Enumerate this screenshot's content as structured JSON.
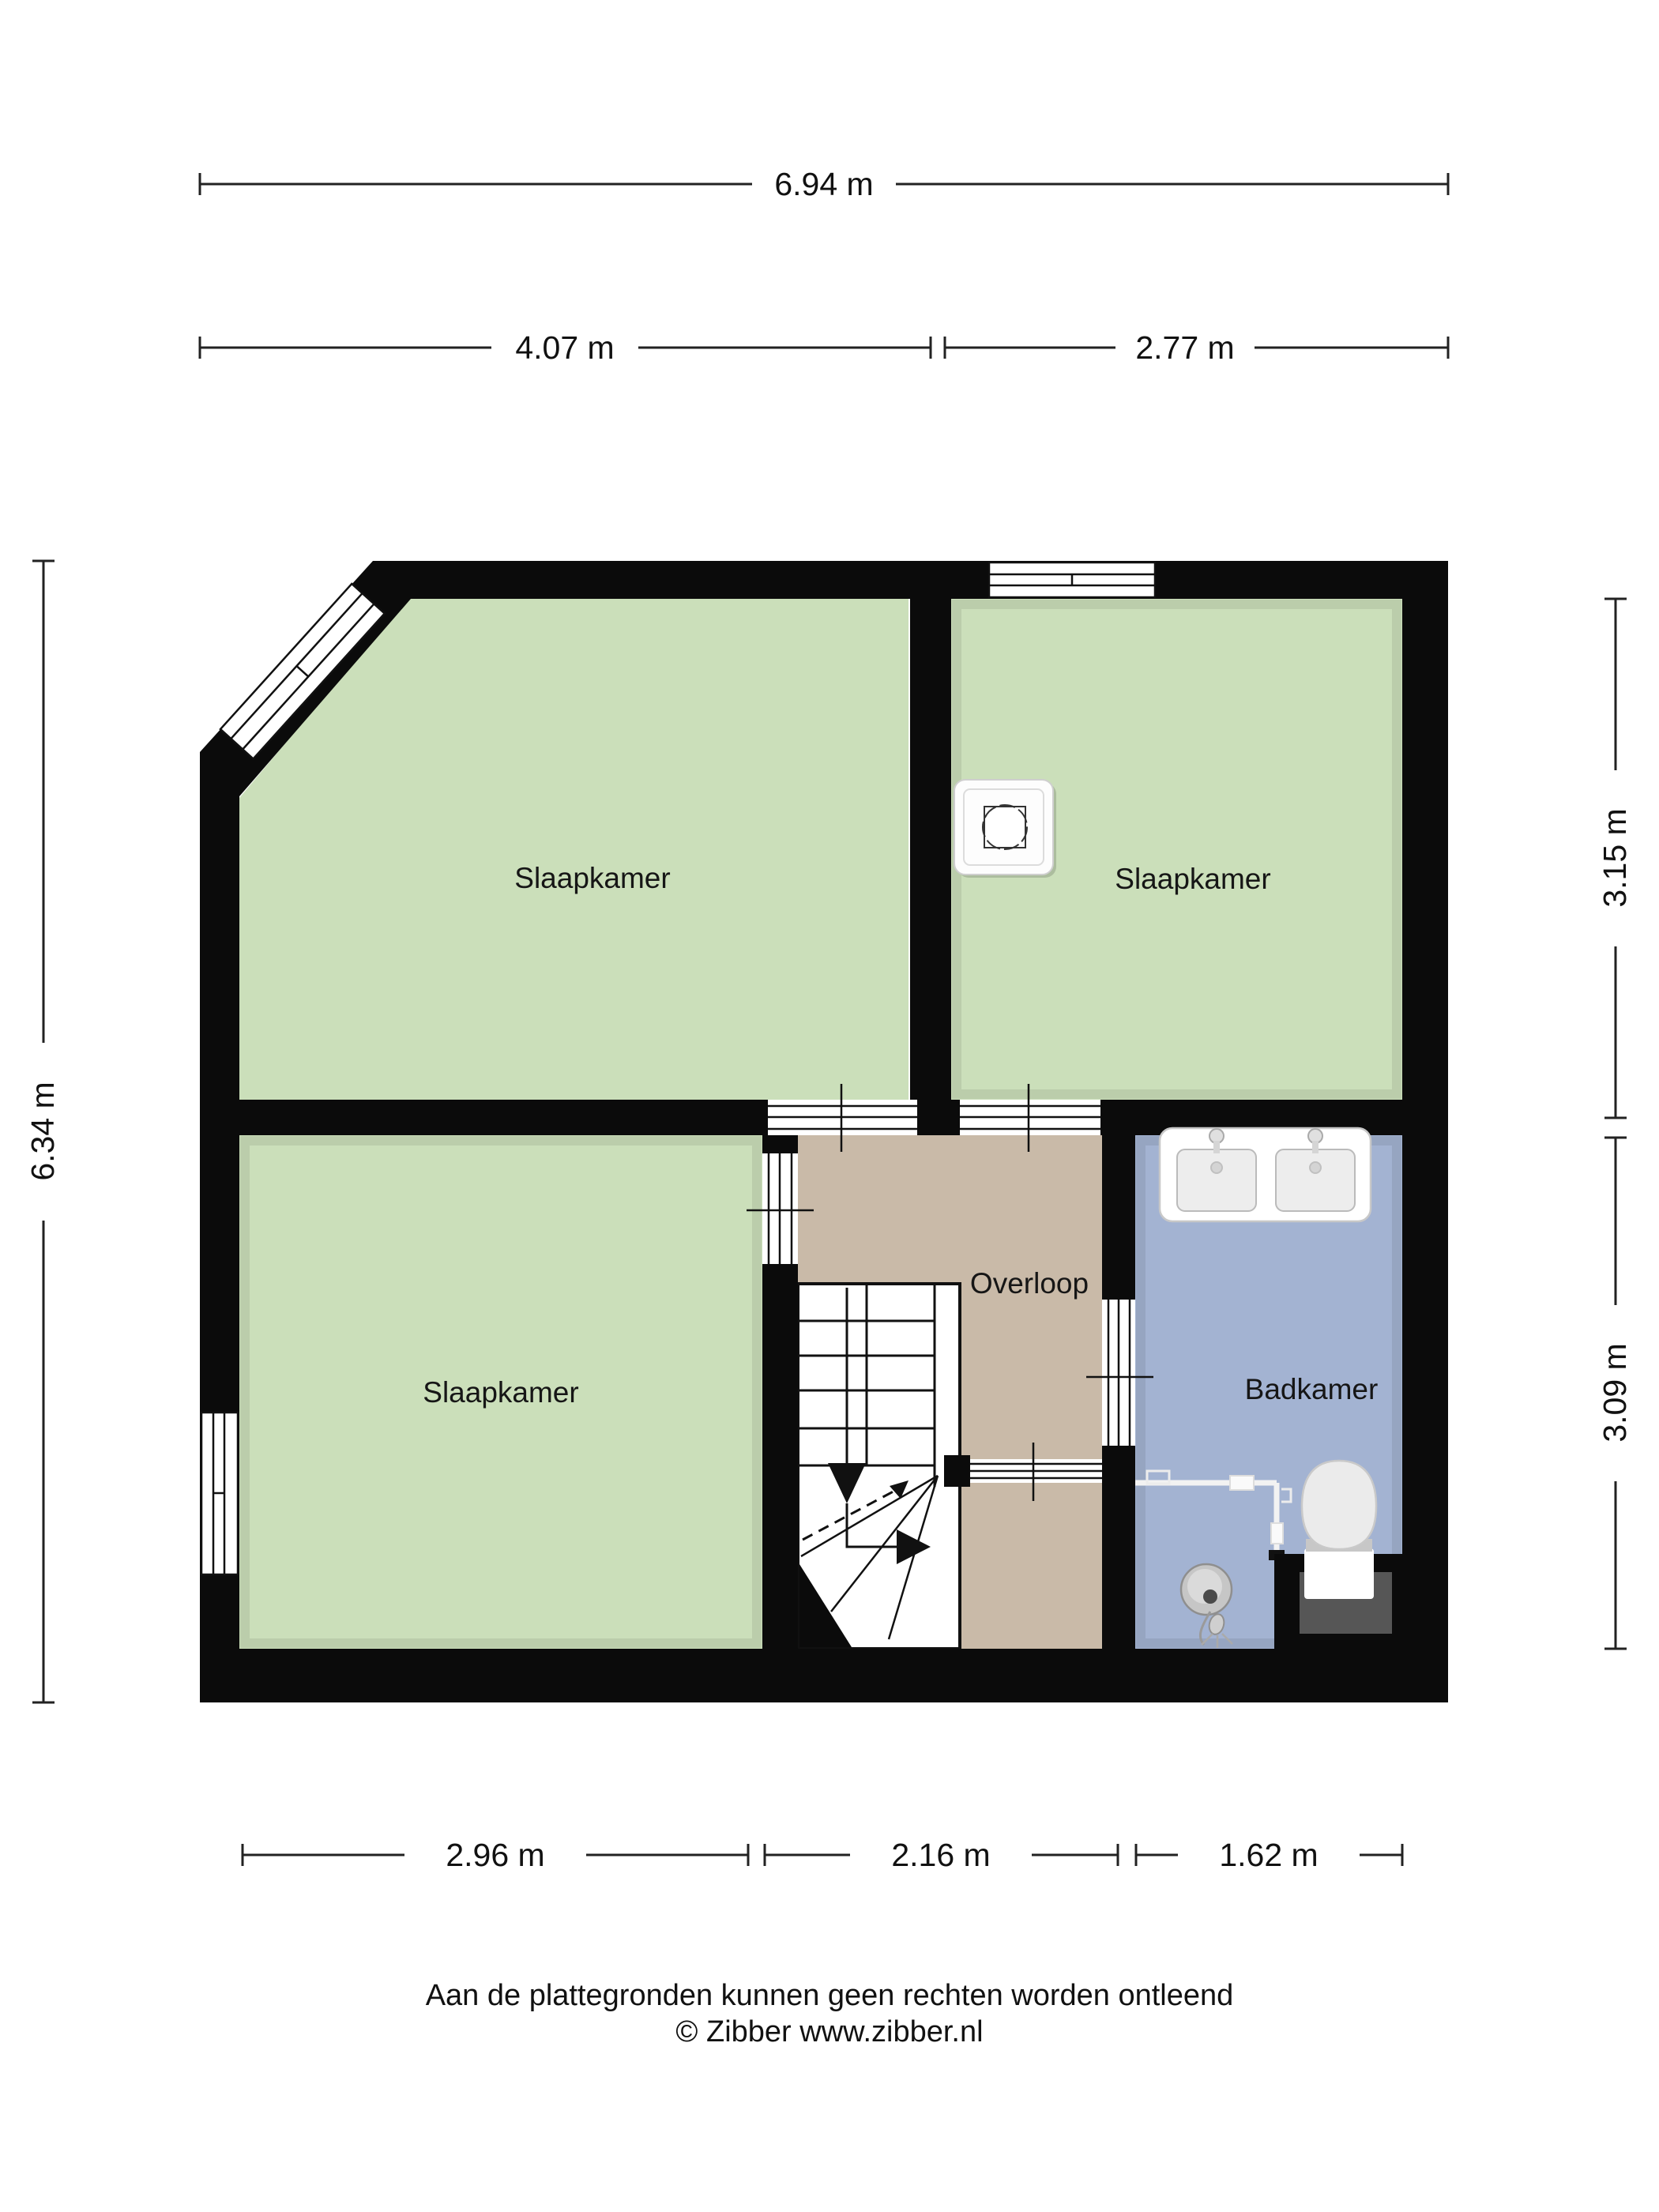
{
  "labels": {
    "bedroom_tl": "Slaapkamer",
    "bedroom_tr": "Slaapkamer",
    "bedroom_bl": "Slaapkamer",
    "landing": "Overloop",
    "bathroom": "Badkamer"
  },
  "dimensions": {
    "total_width": "6.94 m",
    "width_left": "4.07 m",
    "width_right": "2.77 m",
    "total_height": "6.34 m",
    "height_top_right": "3.15 m",
    "height_bottom_right": "3.09 m",
    "bottom_left": "2.96 m",
    "bottom_middle": "2.16 m",
    "bottom_right": "1.62 m"
  },
  "footer": {
    "disclaimer": "Aan de plattegronden kunnen geen rechten worden ontleend",
    "copyright": "© Zibber www.zibber.nl"
  },
  "colors": {
    "bedroom": "#cbdfba",
    "landing": "#c9baa8",
    "bathroom": "#a3b3d2",
    "wall": "#0b0b0b"
  },
  "icons": {
    "ventilation_unit": "ventilation-unit-icon",
    "double_sink": "double-sink-icon",
    "toilet": "toilet-icon",
    "shower": "shower-drain-icon",
    "stairs": "stairs-icon",
    "window": "window-icon",
    "door_opening": "door-opening-icon"
  }
}
